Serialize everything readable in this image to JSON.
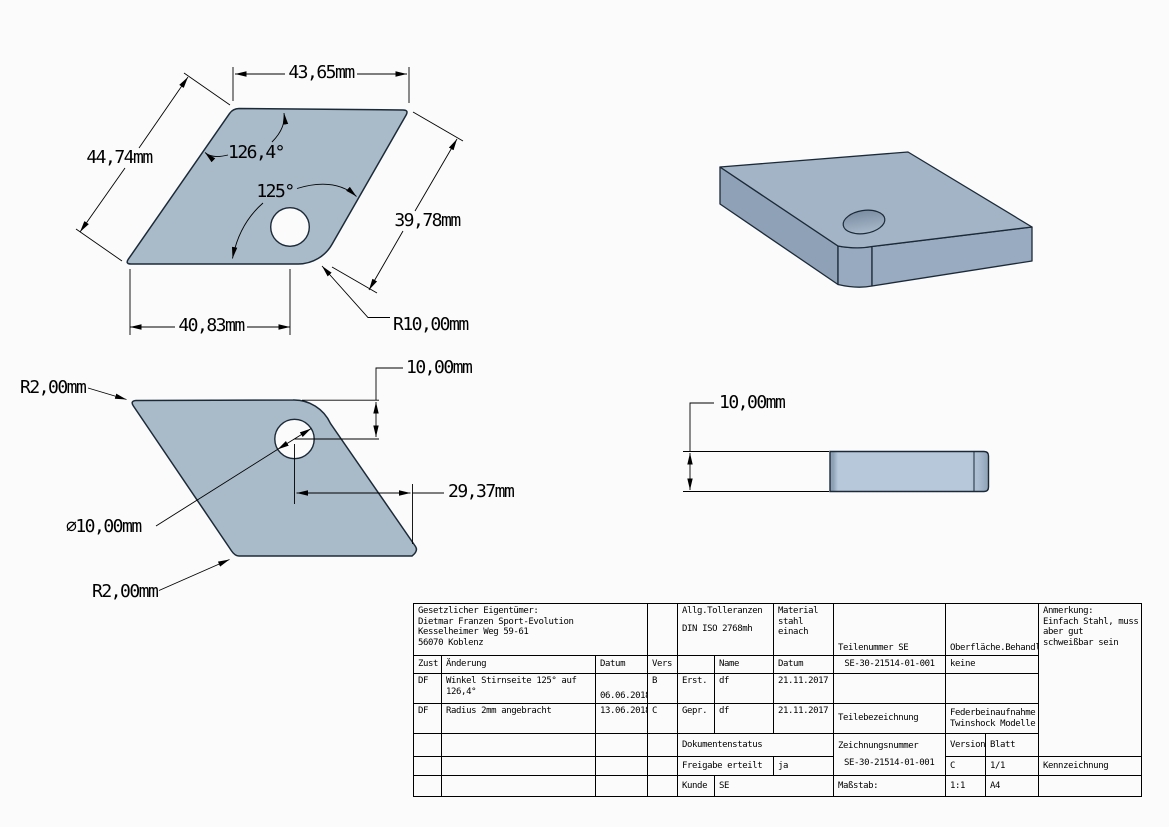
{
  "colors": {
    "background": "#fbfbfb",
    "part_fill": "#a9bac9",
    "part_fill_3d_top": "#a3b4c7",
    "part_fill_3d_front": "#8ea1b6",
    "part_fill_3d_corner": "#97aabf",
    "part_fill_3d_side": "#98abc0",
    "outline": "#1c2a38",
    "dim_line": "#000000"
  },
  "dims": {
    "plan_top_width": "43,65mm",
    "plan_left_side": "44,74mm",
    "plan_right_side": "39,78mm",
    "plan_bottom_width": "40,83mm",
    "plan_corner_radius": "R10,00mm",
    "plan_angle_obtuse": "126,4°",
    "plan_angle_acute": "125°",
    "bottom_hole_offset_v": "10,00mm",
    "bottom_hole_offset_h": "29,37mm",
    "bottom_hole_diameter": "∅10,00mm",
    "bottom_radius_top": "R2,00mm",
    "bottom_radius_bottom": "R2,00mm",
    "side_thickness": "10,00mm"
  },
  "title_block": {
    "owner": {
      "line1": "Gesetzlicher Eigentümer:",
      "line2": "Dietmar Franzen Sport-Evolution",
      "line3": "Kesselheimer Weg 59-61",
      "line4": "56070 Koblenz"
    },
    "tolerances": {
      "line1": "Allg.Tolleranzen",
      "line2": "DIN ISO 2768mh"
    },
    "material": {
      "line1": "Material",
      "line2": "stahl",
      "line3": "einach"
    },
    "headers": {
      "zust": "Zust",
      "aenderung": "Änderung",
      "datum": "Datum",
      "vers": "Vers",
      "name": "Name",
      "datum2": "Datum"
    },
    "revisions": [
      {
        "zust": "DF",
        "aenderung": "Winkel Stirnseite 125° auf 126,4°",
        "datum": "06.06.2018",
        "vers": "B",
        "stage": "Erst.",
        "name": "df",
        "date": "21.11.2017"
      },
      {
        "zust": "DF",
        "aenderung": "Radius 2mm angebracht",
        "datum": "13.06.2018",
        "vers": "C",
        "stage": "Gepr.",
        "name": "df",
        "date": "21.11.2017"
      }
    ],
    "teilenummer_label": "Teilenummer SE",
    "teilenummer_value": "SE-30-21514-01-001",
    "oberflaeche_label": "Oberfläche.Behandl",
    "oberflaeche_value": "keine",
    "teilebezeichnung_label": "Teilebezeichnung",
    "teilebezeichnung_value": {
      "line1": "Federbeinaufnahme",
      "line2": "Twinshock Modelle"
    },
    "dokumentenstatus_label": "Dokumentenstatus",
    "freigabe_label": "Freigabe erteilt",
    "freigabe_value": "ja",
    "kunde_label": "Kunde",
    "kunde_value": "SE",
    "zeichnungsnummer_label": "Zeichnungsnummer",
    "zeichnungsnummer_value": "SE-30-21514-01-001",
    "version_label": "Version",
    "version_value": "C",
    "blatt_label": "Blatt",
    "blatt_value": "1/1",
    "massstab_label": "Maßstab:",
    "massstab_value": "1:1",
    "format_value": "A4",
    "anmerkung": {
      "line1": "Anmerkung:",
      "line2": "Einfach Stahl, muss",
      "line3": "aber gut",
      "line4": "schweißbar sein"
    },
    "kennzeichnung_label": "Kennzeichnung"
  }
}
